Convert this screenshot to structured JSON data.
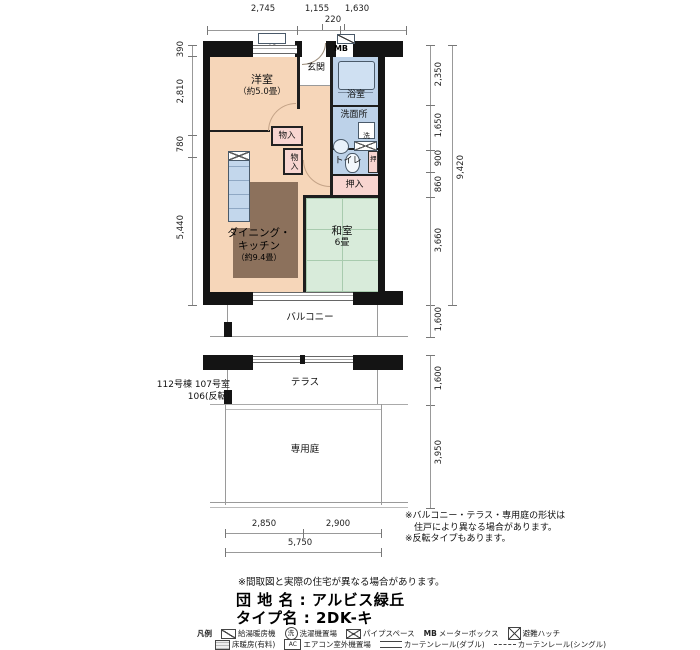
{
  "title": {
    "danchi": "団 地 名 : アルビス緑丘",
    "type": "タイプ名 : 2DK-キ"
  },
  "notes": {
    "shape1": "※バルコニー・テラス・専用庭の形状は",
    "shape2": "　住戸により異なる場合があります。",
    "shape3": "※反転タイプもあります。",
    "madori": "※間取図と実際の住宅が異なる場合があります。"
  },
  "unit_info": {
    "line1": "112号棟 107号室",
    "line2": "106(反転)"
  },
  "rooms": {
    "yoshitsu_name": "洋室",
    "yoshitsu_size": "（約5.0畳）",
    "genkan": "玄関",
    "yokushitsu": "浴室",
    "senmenjo": "洗面所",
    "sentaku": "洗",
    "toire": "トイレ",
    "oshi": "押",
    "oshiire": "押入",
    "mononyu1": "物入",
    "mononyu2": "物入",
    "dk_name1": "ダイニング・",
    "dk_name2": "キッチン",
    "dk_size": "（約9.4畳）",
    "washitsu_name": "和室",
    "washitsu_size": "6畳",
    "balcony": "バルコニー",
    "terrace": "テラス",
    "garden": "専用庭",
    "mb": "MB",
    "ac": "AC"
  },
  "dims": {
    "top": [
      "2,745",
      "1,155",
      "1,630"
    ],
    "top_sub": "220",
    "left": [
      "390",
      "2,810",
      "780",
      "5,440"
    ],
    "right": [
      "2,350",
      "1,650",
      "900",
      "860",
      "3,660"
    ],
    "right_total": "9,420",
    "balcony_depth": "1,600",
    "terrace_depth": "1,600",
    "garden_depth": "3,950",
    "bottom": [
      "2,850",
      "2,900"
    ],
    "bottom_total": "5,750"
  },
  "legend": {
    "title": "凡例",
    "row1": [
      {
        "label": "給湯暖房機"
      },
      {
        "icon_text": "洗",
        "label": "洗濯機置場"
      },
      {
        "label": "パイプスペース"
      },
      {
        "prefix": "MB",
        "label": "メーターボックス"
      },
      {
        "label": "避難ハッチ"
      }
    ],
    "row2": [
      {
        "label": "床暖房(有料)"
      },
      {
        "icon_text": "AC",
        "label": "エアコン室外機置場"
      },
      {
        "label": "カーテンレール(ダブル)"
      },
      {
        "label": "カーテンレール(シングル)"
      }
    ]
  },
  "colors": {
    "room_peach": "#f6d6b9",
    "wet_blue": "#bdd2e9",
    "tatami_green": "#d8ebda",
    "closet_pink": "#f8d5d0",
    "floor_heating_brown": "#8c715c",
    "wall_black": "#141414"
  }
}
